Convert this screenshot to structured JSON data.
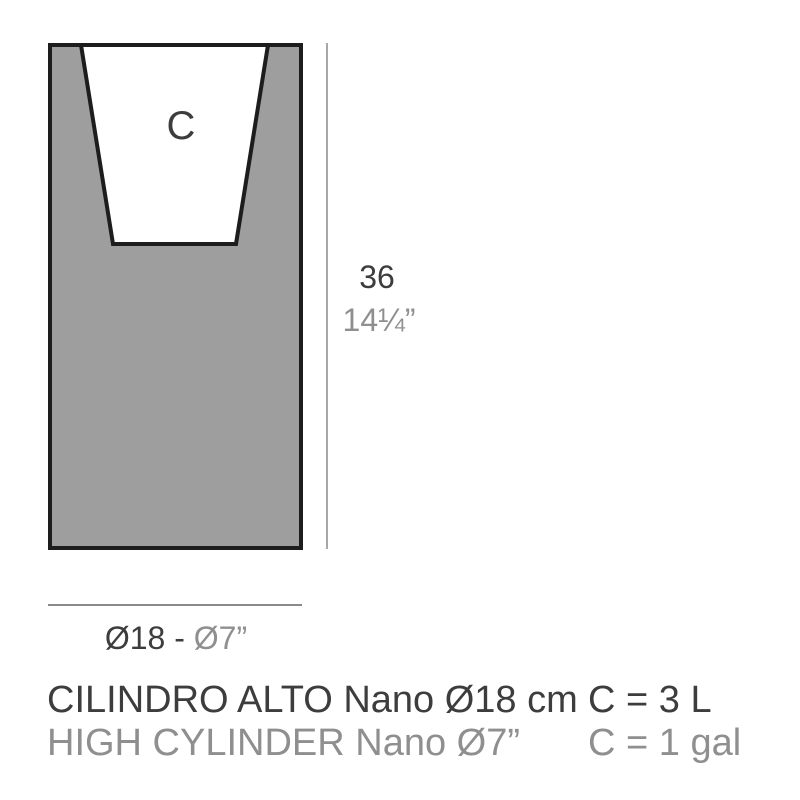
{
  "figure": {
    "cavity_label": "C",
    "height_cm": "36",
    "height_in": "14¼”",
    "diameter_cm_part": "Ø18 - ",
    "diameter_in_part": "Ø7”"
  },
  "captions": {
    "product_name_es": "CILINDRO ALTO Nano Ø18 cm",
    "product_name_en": "HIGH CYLINDER Nano Ø7”",
    "capacity_liters": "C = 3 L",
    "capacity_gallons": "C = 1 gal"
  },
  "colors": {
    "dark_text": "#3d3d3d",
    "light_text": "#8f8f8f",
    "body_fill": "#9e9e9e",
    "outline": "#1d1d1d",
    "dimension_line": "#8a8a8a"
  }
}
